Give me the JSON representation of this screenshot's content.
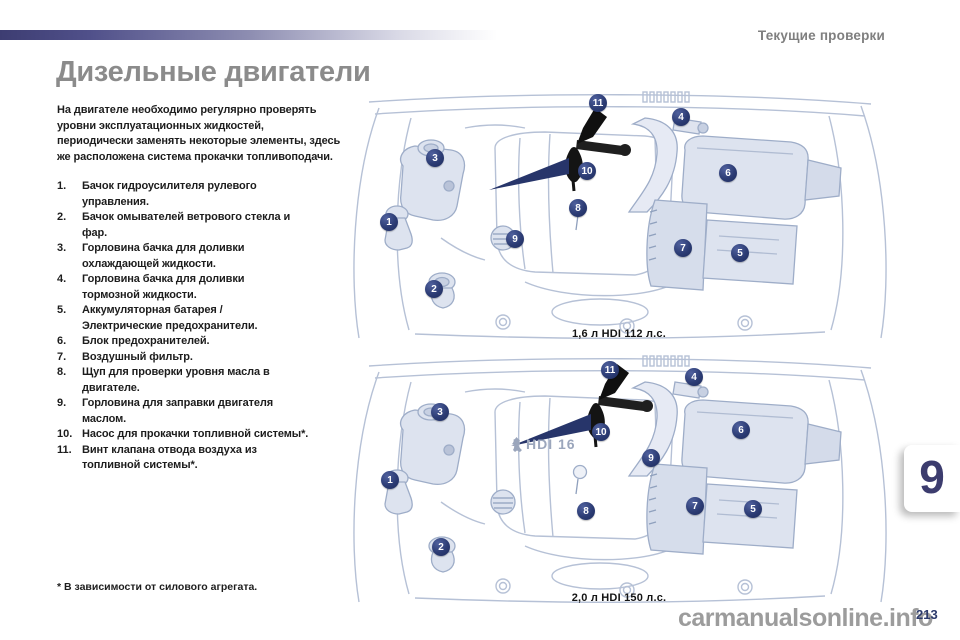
{
  "page": {
    "running_header": "Текущие проверки",
    "title": "Дизельные двигатели",
    "intro": "На двигателе необходимо регулярно проверять\nуровни эксплуатационных жидкостей,\nпериодически заменять некоторые элементы, здесь\nже расположена система прокачки топливоподачи.",
    "footnote": "* В зависимости от силового агрегата.",
    "chapter_number": "9",
    "page_number": "213",
    "watermark": "carmanualsonline.info"
  },
  "legend": {
    "items": [
      {
        "num": "1.",
        "text": "Бачок гидроусилителя рулевого\nуправления."
      },
      {
        "num": "2.",
        "text": "Бачок омывателей ветрового стекла и\nфар."
      },
      {
        "num": "3.",
        "text": "Горловина бачка для доливки\nохлаждающей жидкости."
      },
      {
        "num": "4.",
        "text": "Горловина бачка для доливки\nтормозной жидкости."
      },
      {
        "num": "5.",
        "text": "Аккумуляторная батарея /\nЭлектрические предохранители."
      },
      {
        "num": "6.",
        "text": "Блок предохранителей."
      },
      {
        "num": "7.",
        "text": "Воздушный фильтр."
      },
      {
        "num": "8.",
        "text": "Щуп для проверки уровня масла в\nдвигателе."
      },
      {
        "num": "9.",
        "text": "Горловина для заправки двигателя\nмаслом."
      },
      {
        "num": "10.",
        "text": "Насос для прокачки топливной системы*."
      },
      {
        "num": "11.",
        "text": "Винт клапана отвода воздуха из\nтопливной системы*."
      }
    ]
  },
  "diagrams": [
    {
      "caption": "1,6 л HDI 112 л.с.",
      "engine_badge": "",
      "callouts": [
        {
          "n": "1",
          "x": 44,
          "y": 134
        },
        {
          "n": "2",
          "x": 89,
          "y": 201
        },
        {
          "n": "3",
          "x": 90,
          "y": 70
        },
        {
          "n": "4",
          "x": 336,
          "y": 29
        },
        {
          "n": "5",
          "x": 395,
          "y": 165
        },
        {
          "n": "6",
          "x": 383,
          "y": 85
        },
        {
          "n": "7",
          "x": 338,
          "y": 160
        },
        {
          "n": "8",
          "x": 233,
          "y": 120
        },
        {
          "n": "9",
          "x": 170,
          "y": 151
        },
        {
          "n": "10",
          "x": 242,
          "y": 83
        },
        {
          "n": "11",
          "x": 253,
          "y": 15
        }
      ]
    },
    {
      "caption": "2,0 л HDI 150 л.с.",
      "engine_badge": "HDI 16",
      "callouts": [
        {
          "n": "1",
          "x": 45,
          "y": 128
        },
        {
          "n": "2",
          "x": 96,
          "y": 195
        },
        {
          "n": "3",
          "x": 95,
          "y": 60
        },
        {
          "n": "4",
          "x": 349,
          "y": 25
        },
        {
          "n": "5",
          "x": 408,
          "y": 157
        },
        {
          "n": "6",
          "x": 396,
          "y": 78
        },
        {
          "n": "7",
          "x": 350,
          "y": 154
        },
        {
          "n": "8",
          "x": 241,
          "y": 159
        },
        {
          "n": "9",
          "x": 306,
          "y": 106
        },
        {
          "n": "10",
          "x": 256,
          "y": 80
        },
        {
          "n": "11",
          "x": 265,
          "y": 18
        }
      ]
    }
  ],
  "colors": {
    "accent_navy": "#2c3a6b",
    "line_art": "#b6c1d6",
    "title_gray": "#8b8b8b"
  }
}
